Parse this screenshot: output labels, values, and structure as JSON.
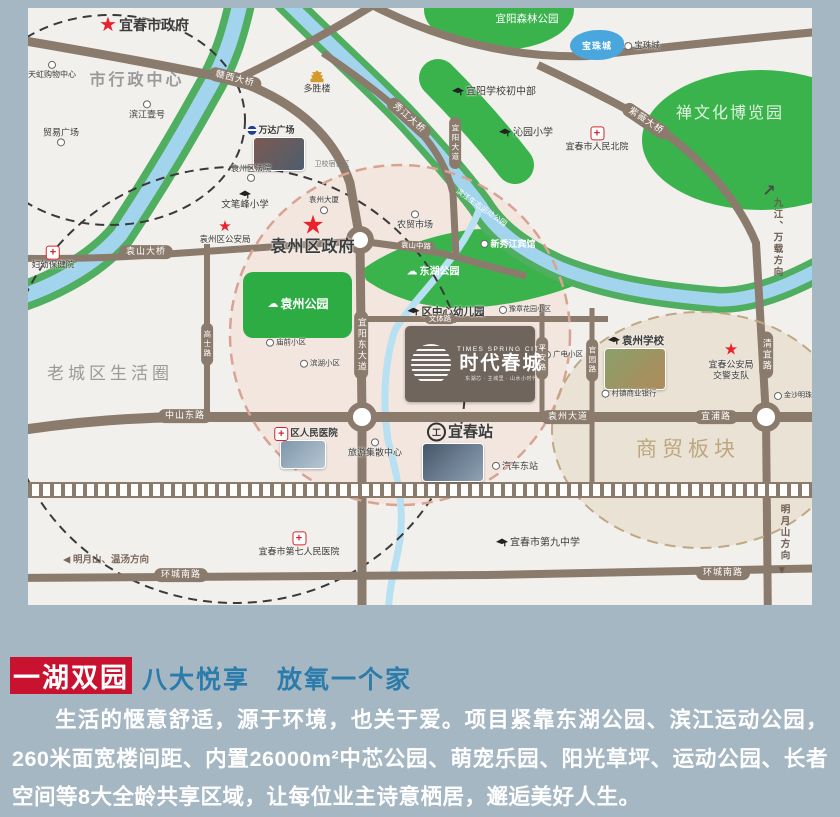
{
  "page": {
    "bg": "#a6b7c4"
  },
  "map": {
    "bg": "#f2f0ec",
    "road_color": "#8b7b6d",
    "water_color": "#a3d4ee",
    "park_color": "#3bb34d",
    "lake": {
      "label": "宝珠城"
    },
    "project": {
      "en": "TIMES SPRING CITY",
      "cn": "时代春城",
      "tag": "东湖芯 · 主城里 · 山水小时代"
    },
    "markers": [
      {
        "name": "yichun-city-gov",
        "icon": "star",
        "iconSize": 20,
        "label": "宜春市政府",
        "x": 116,
        "y": 17,
        "fs": 14,
        "bold": 1
      },
      {
        "name": "admin-center-text",
        "label": "市行政中心",
        "x": 109,
        "y": 73,
        "fs": 16,
        "color": "#9a9a9a",
        "bold": 1,
        "ls": 3
      },
      {
        "name": "tianhong-mall",
        "icon": "dot",
        "label": "天虹购物中心",
        "x": 24,
        "y": 62,
        "fs": 8,
        "dir": "col"
      },
      {
        "name": "binjiang-one",
        "icon": "dot",
        "label": "滨江壹号",
        "x": 119,
        "y": 102,
        "fs": 9,
        "dir": "col"
      },
      {
        "name": "maoyi-square",
        "icon": "dot",
        "label": "贸易广场",
        "x": 33,
        "y": 129,
        "fs": 9,
        "dir": "col",
        "iconAfter": 1
      },
      {
        "name": "duoshenglou",
        "icon": "building",
        "label": "多胜楼",
        "x": 289,
        "y": 74,
        "fs": 9,
        "dir": "col"
      },
      {
        "name": "wanda-plaza",
        "icon": "wanda",
        "label": "万达广场",
        "x": 243,
        "y": 122,
        "fs": 9,
        "bold": 1
      },
      {
        "name": "yuanzhou-court",
        "icon": "dot",
        "label": "袁州区法院",
        "x": 223,
        "y": 165,
        "fs": 8,
        "dir": "col",
        "iconAfter": 1
      },
      {
        "name": "weixiao-dorm",
        "label": "卫校宿舍区",
        "x": 304,
        "y": 157,
        "fs": 7,
        "color": "#7a7a7a"
      },
      {
        "name": "yuanzhou-tower",
        "icon": "dot",
        "label": "袁州大厦",
        "x": 296,
        "y": 197,
        "fs": 7.5,
        "dir": "col",
        "iconAfter": 1
      },
      {
        "name": "wenbifeng-school",
        "icon": "school",
        "label": "文笔峰小学",
        "x": 217,
        "y": 193,
        "fs": 9.5,
        "dir": "col"
      },
      {
        "name": "yuanzhou-police",
        "icon": "star",
        "iconSize": 15,
        "label": "袁州区公安局",
        "x": 197,
        "y": 224,
        "fs": 8.5,
        "dir": "col"
      },
      {
        "name": "yuanzhou-gov",
        "icon": "star",
        "iconSize": 26,
        "label": "袁州区政府",
        "x": 285,
        "y": 226,
        "fs": 16,
        "bold": 1,
        "dir": "col",
        "ls": 1
      },
      {
        "name": "nongmao-market",
        "icon": "dot",
        "label": "农贸市场",
        "x": 387,
        "y": 212,
        "fs": 9,
        "dir": "col"
      },
      {
        "name": "yiyang-middle-school",
        "icon": "school",
        "label": "宜阳学校初中部",
        "x": 466,
        "y": 84,
        "fs": 10
      },
      {
        "name": "qinyuan-primary",
        "icon": "school",
        "label": "沁园小学",
        "x": 498,
        "y": 125,
        "fs": 10
      },
      {
        "name": "renmin-north-hospital",
        "icon": "cross",
        "label": "宜春市人民北院",
        "x": 569,
        "y": 131,
        "fs": 9,
        "dir": "col"
      },
      {
        "name": "fuyou-hospital",
        "icon": "cross",
        "label": "妇幼保健院",
        "x": 25,
        "y": 250,
        "fs": 8.5,
        "dir": "col"
      },
      {
        "name": "baozhu-city",
        "icon": "dot",
        "label": "宝珠城",
        "x": 614,
        "y": 38,
        "fs": 8.5
      },
      {
        "name": "yiyang-forest-text",
        "label": "宜阳森林公园",
        "x": 499,
        "y": 11,
        "fs": 10.5,
        "color": "#ffffff"
      },
      {
        "name": "zen-expo-text",
        "label": "禅文化博览园",
        "x": 702,
        "y": 106,
        "fs": 16,
        "color": "#dff3e0",
        "ls": 2
      },
      {
        "name": "binjiang-sport-text",
        "label": "滨江生态运动公园",
        "x": 453,
        "y": 200,
        "fs": 7.5,
        "color": "#ffffff",
        "rot": 35
      },
      {
        "name": "xinxiujiang-hotel",
        "icon": "dot",
        "label": "新秀江宾馆",
        "x": 480,
        "y": 236,
        "fs": 9,
        "color": "#ffffff",
        "bold": 1
      },
      {
        "name": "donghu-park",
        "icon": "cloud",
        "label": "东湖公园",
        "x": 405,
        "y": 264,
        "fs": 10,
        "color": "#ffffff",
        "bold": 1
      },
      {
        "name": "yuanzhou-park",
        "icon": "cloud",
        "label": "袁州公园",
        "x": 270,
        "y": 297,
        "fs": 12,
        "color": "#ffffff",
        "bold": 1
      },
      {
        "name": "central-kindergarten",
        "icon": "school",
        "label": "区中心幼儿园",
        "x": 418,
        "y": 304,
        "fs": 10.5,
        "bold": 1
      },
      {
        "name": "yuzhang-garden-estate",
        "icon": "dot",
        "label": "豫章花园小区",
        "x": 497,
        "y": 302,
        "fs": 7
      },
      {
        "name": "miaoqian-estate",
        "icon": "dot",
        "label": "庙前小区",
        "x": 258,
        "y": 335,
        "fs": 7.5
      },
      {
        "name": "binhu-estate",
        "icon": "dot",
        "label": "滨湖小区",
        "x": 292,
        "y": 356,
        "fs": 7.5
      },
      {
        "name": "guangdian-estate",
        "icon": "dot",
        "label": "广电小区",
        "x": 535,
        "y": 347,
        "fs": 7.5
      },
      {
        "name": "yuanzhou-school",
        "icon": "school",
        "label": "袁州学校",
        "x": 608,
        "y": 333,
        "fs": 10.5,
        "bold": 1
      },
      {
        "name": "traffic-police",
        "icon": "star",
        "iconSize": 16,
        "label": "宜春公安局",
        "label2": "交警支队",
        "x": 703,
        "y": 354,
        "fs": 9,
        "dir": "col"
      },
      {
        "name": "rural-bank",
        "icon": "dot",
        "label": "村镇商业银行",
        "x": 601,
        "y": 386,
        "fs": 7.5
      },
      {
        "name": "jinsha-plaza",
        "icon": "dot",
        "label": "金沙明珠广场",
        "x": 772,
        "y": 388,
        "fs": 7
      },
      {
        "name": "old-town-text",
        "label": "老城区生活圈",
        "x": 82,
        "y": 366,
        "fs": 17,
        "color": "#9a9a9a",
        "ls": 4
      },
      {
        "name": "district-renmin-hospital",
        "icon": "cross",
        "label": "区人民医院",
        "x": 278,
        "y": 426,
        "fs": 9.5,
        "bold": 1
      },
      {
        "name": "tourist-center",
        "icon": "dot",
        "label": "旅游集散中心",
        "x": 347,
        "y": 440,
        "fs": 9,
        "dir": "col"
      },
      {
        "name": "yichun-station",
        "icon": "train",
        "label": "宜春站",
        "x": 432,
        "y": 424,
        "fs": 15,
        "bold": 1
      },
      {
        "name": "bus-east-station",
        "icon": "dot",
        "label": "汽车东站",
        "x": 487,
        "y": 458,
        "fs": 9
      },
      {
        "name": "trade-block-text",
        "label": "商贸板块",
        "x": 660,
        "y": 442,
        "fs": 21,
        "color": "#bda77e",
        "ls": 5
      },
      {
        "name": "seventh-renmin-hospital",
        "icon": "cross",
        "label": "宜春市第七人民医院",
        "x": 271,
        "y": 536,
        "fs": 9,
        "dir": "col"
      },
      {
        "name": "ninth-middle-school",
        "icon": "school",
        "label": "宜春市第九中学",
        "x": 510,
        "y": 535,
        "fs": 10
      },
      {
        "name": "mingyue-wentang-dir",
        "label": "◀  明月山、温汤方向",
        "x": 78,
        "y": 553,
        "fs": 9.5,
        "color": "#7a6a5e",
        "bold": 1
      },
      {
        "name": "jiujiang-wanzai-arrow",
        "label": "↗",
        "x": 741,
        "y": 184,
        "fs": 16,
        "color": "#4a4a4a",
        "bold": 1
      },
      {
        "name": "jiujiang-wanzai-dir",
        "label": "九江、万载方向",
        "x": 748,
        "y": 230,
        "fs": 9.5,
        "color": "#6b5b4f",
        "bold": 1,
        "vert": 1
      },
      {
        "name": "mingyueshan-dir",
        "label": "明月山方向",
        "x": 755,
        "y": 525,
        "fs": 9.5,
        "color": "#6b5b4f",
        "bold": 1,
        "vert": 1
      },
      {
        "name": "mingyueshan-arrow",
        "label": "▼",
        "x": 754,
        "y": 563,
        "fs": 11,
        "color": "#6b5b4f"
      }
    ],
    "pills": [
      {
        "name": "ganxi-bridge",
        "label": "赣西大桥",
        "x": 207,
        "y": 71,
        "rot": 14
      },
      {
        "name": "yuanshan-bridge",
        "label": "袁山大桥",
        "x": 118,
        "y": 244
      },
      {
        "name": "xiujiang-bridge",
        "label": "秀江大桥",
        "x": 381,
        "y": 110,
        "rot": 42
      },
      {
        "name": "ziwei-bridge",
        "label": "紫薇大桥",
        "x": 618,
        "y": 113,
        "rot": 34
      },
      {
        "name": "yuanshan-mid-road",
        "label": "袁山中路",
        "x": 388,
        "y": 238,
        "rot": 3,
        "tiny": 1
      },
      {
        "name": "wenti-road",
        "label": "文体路",
        "x": 412,
        "y": 311,
        "tiny": 1
      },
      {
        "name": "zhongshan-east-road",
        "label": "中山东路",
        "x": 157,
        "y": 408
      },
      {
        "name": "yuanzhou-avenue",
        "label": "袁州大道",
        "x": 540,
        "y": 409
      },
      {
        "name": "yipu-road",
        "label": "宜浦路",
        "x": 688,
        "y": 409
      },
      {
        "name": "huancheng-south-west",
        "label": "环城南路",
        "x": 153,
        "y": 567
      },
      {
        "name": "huancheng-south-east",
        "label": "环城南路",
        "x": 695,
        "y": 565
      },
      {
        "name": "qingyi-road",
        "label": "清宜路",
        "x": 738,
        "y": 347,
        "vert": 1
      },
      {
        "name": "yiyang-east-avenue",
        "label": "宜阳东大道",
        "x": 333,
        "y": 337,
        "vert": 1
      },
      {
        "name": "yiyang-avenue",
        "label": "宜阳大道",
        "x": 427,
        "y": 135,
        "vert": 1,
        "tiny": 1
      },
      {
        "name": "gaoshi-road",
        "label": "高士路",
        "x": 179,
        "y": 336,
        "vert": 1,
        "tiny": 1
      },
      {
        "name": "pingan-road",
        "label": "平安路",
        "x": 514,
        "y": 350,
        "vert": 1,
        "tiny": 1
      },
      {
        "name": "guanyuan-road",
        "label": "官园路",
        "x": 564,
        "y": 352,
        "vert": 1,
        "tiny": 1
      }
    ],
    "thumbs": [
      {
        "name": "wanda-photo",
        "x": 225,
        "y": 129,
        "w": 50,
        "h": 32,
        "c1": "#7c5a52",
        "c2": "#4e5d6e"
      },
      {
        "name": "yuanzhou-school-photo",
        "x": 576,
        "y": 340,
        "w": 60,
        "h": 40,
        "c1": "#8aa06a",
        "c2": "#b08a5a"
      },
      {
        "name": "district-hospital-photo",
        "x": 252,
        "y": 432,
        "w": 44,
        "h": 27,
        "c1": "#7e97ab",
        "c2": "#b6c6d2"
      },
      {
        "name": "station-photo",
        "x": 394,
        "y": 435,
        "w": 60,
        "h": 37,
        "c1": "#46566a",
        "c2": "#8fa3b5"
      }
    ]
  },
  "bottom": {
    "badge": "一湖双园",
    "headline": "八大悦享　放氧一个家",
    "paragraph": "生活的惬意舒适，源于环境，也关于爱。项目紧靠东湖公园、滨江运动公园，260米面宽楼间距、内置26000m²中芯公园、萌宠乐园、阳光草坪、运动公园、长者空间等8大全龄共享区域，让每位业主诗意栖居，邂逅美好人生。"
  }
}
